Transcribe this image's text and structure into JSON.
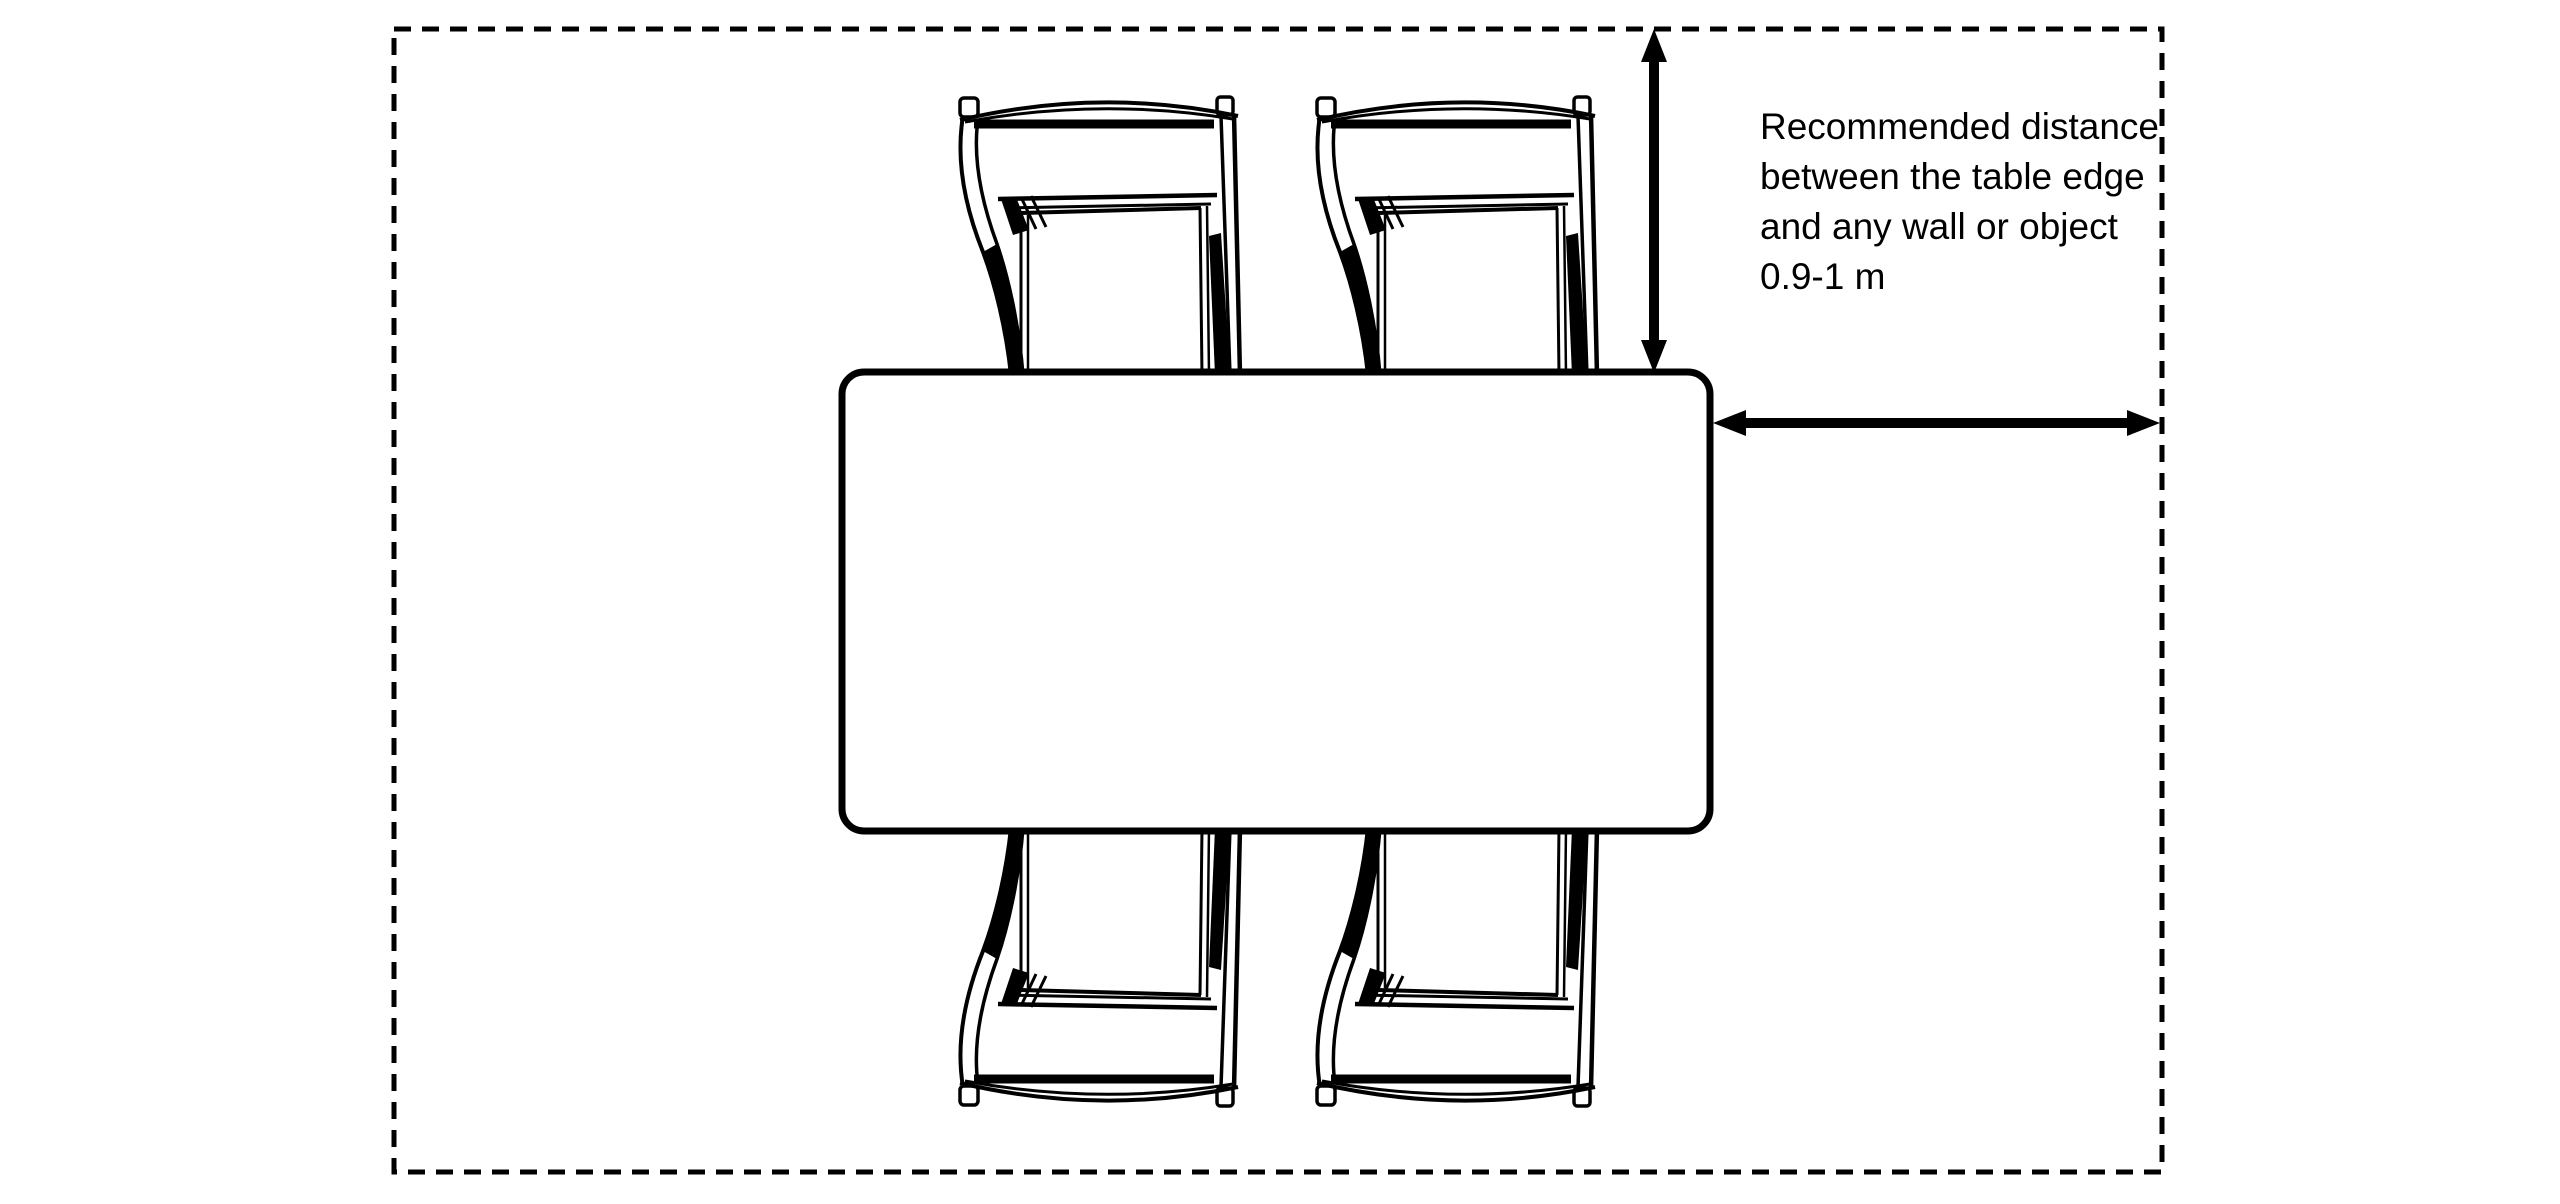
{
  "annotation": {
    "lines": [
      "Recommended distance",
      "between the table edge",
      "and any wall or object",
      "0.9-1 m"
    ]
  },
  "colors": {
    "ink": "#000000",
    "background": "#ffffff"
  },
  "shapes": {
    "room_boundary": "dashed-rectangle-wall-outline",
    "table": "rounded-rectangle-table-top-view",
    "chairs": [
      "chair-top-left",
      "chair-top-right",
      "chair-bottom-left",
      "chair-bottom-right"
    ],
    "arrows": [
      "vertical-clearance-arrow",
      "horizontal-clearance-arrow"
    ]
  }
}
